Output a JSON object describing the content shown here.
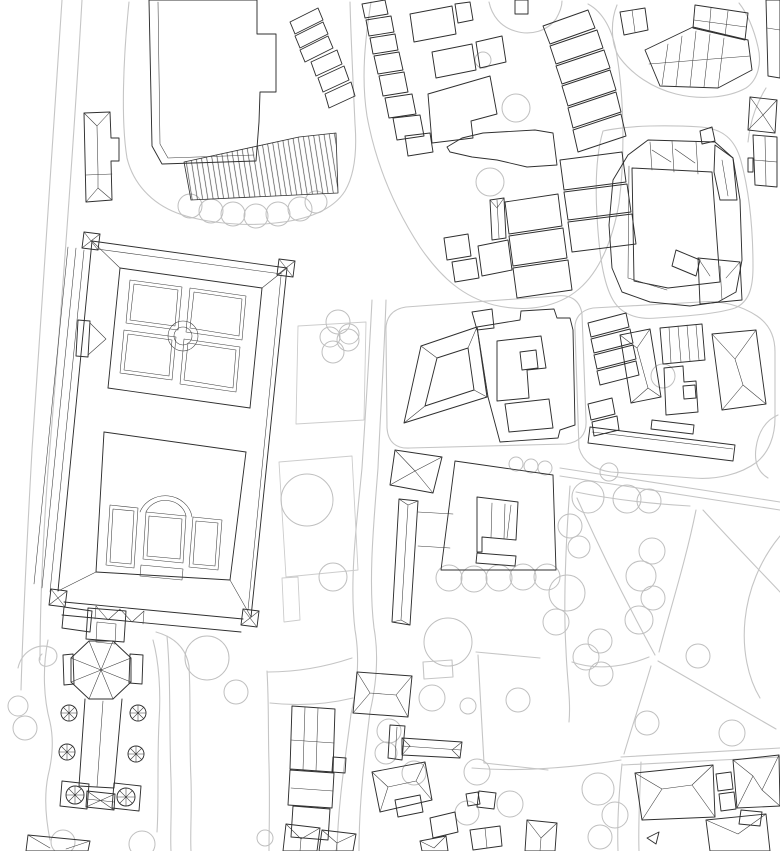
{
  "canvas": {
    "width": 780,
    "height": 851,
    "background": "#ffffff"
  },
  "palette": {
    "ink": "#2f2f2f",
    "detail": "#3c3c3c",
    "road": "#c5c5c5",
    "tree": "#bfbfbf",
    "bed": "#cccccc",
    "hatch": "#4a4a4a"
  },
  "layers": [
    {
      "id": "roads",
      "color": "road",
      "width": 1.1,
      "paths": [
        "M62,0 C54,130 42,300 32,450 C27,540 23,620 21,690",
        "M82,0 C74,140 60,330 48,470 C43,540 40,600 40,660",
        "M129,2 C123,60 121,122 127,158 C133,183 151,203 177,213 C201,222 241,227 275,223 C307,220 333,210 345,191 C355,174 357,150 355,124 C353,80 351,40 350,2",
        "M371,2 C365,40 361,78 367,116 C375,160 392,204 420,247 C442,279 464,297 494,305 C527,313 558,307 579,289 C600,271 613,239 619,203 C625,158 624,98 617,56 C613,30 603,12 588,4",
        "M489,2 C492,16 501,27 515,31 C531,36 547,31 556,19 C560,12 562,6 562,1",
        "M617,5 C610,22 611,46 620,58 C632,74 652,88 676,94 C700,100 728,98 746,88 C758,80 762,63 758,47 C754,29 747,13 739,3",
        "M603,131 C597,151 595,181 597,216 C599,252 603,283 613,300 C621,314 637,320 657,318 C687,316 717,314 735,308 C749,302 753,288 753,267 C753,229 749,191 741,161 C735,139 723,129 701,127 C669,125 630,125 603,131 Z",
        "M766,88 C756,104 750,122 748,142",
        "M386,332 C385,318 392,309 406,307 L556,296 C570,294 580,300 582,314 L586,420 C587,434 580,442 566,444 L410,448 C396,449 388,442 387,428 Z",
        "M575,330 C574,318 581,310 593,308 L700,302 C722,300 742,306 757,316 C769,324 775,336 775,352 L775,418 C775,436 769,452 757,462 C741,474 717,480 693,478 L611,472 C595,470 583,462 579,448 Z",
        "M560,468 L780,502",
        "M560,476 L780,510",
        "M372,300 C369,360 365,420 362,468 C357,520 349,580 355,630 C360,658 357,688 351,714 C346,754 338,802 337,851",
        "M386,300 C384,360 380,420 378,468 C374,520 368,580 374,628 C379,656 376,686 370,712 C365,752 359,802 359,851",
        "M352,658 C322,668 294,672 268,672",
        "M353,698 C324,705 297,706 270,703",
        "M189,666 C191,700 189,740 191,780 C192,812 190,832 191,851",
        "M267,671 C269,704 268,734 269,764 C270,802 269,830 269,851",
        "M189,666 C186,648 174,637 156,632",
        "M570,486 C566,540 563,600 566,650 C567,680 571,700 569,722",
        "M576,492 C615,500 655,504 690,506",
        "M577,498 C598,545 625,600 655,655",
        "M696,510 C686,560 670,610 659,652",
        "M703,510 C733,543 762,573 780,592",
        "M658,661 L776,729",
        "M651,666 C641,700 631,730 624,754",
        "M621,757 L780,748",
        "M623,765 L780,757",
        "M649,657 C622,668 594,670 572,662",
        "M780,536 C760,560 748,590 745,620 C742,650 748,678 760,698",
        "M622,764 C619,792 617,822 618,851",
        "M641,762 C640,792 638,822 639,851",
        "M621,760 C570,768 520,772 472,768",
        "M778,415 C766,420 758,432 756,448 C754,462 758,472 768,478",
        "M476,652 L540,658 M478,655 L484,763 M484,763 L548,770",
        "M153,640 C159,662 161,692 159,722 C157,762 159,802 157,832",
        "M167,636 C171,680 169,730 171,780 C172,812 170,832 171,851",
        "M48,640 C42,670 44,700 50,722 C54,740 52,760 48,776 C44,796 46,820 50,840",
        "M18,668 C22,650 40,642 52,648 C60,652 58,664 48,666 C40,668 36,659 42,654",
        "M423,662 L452,660 L453,677 L424,679 Z"
      ]
    },
    {
      "id": "garden-beds",
      "color": "bed",
      "width": 0.9,
      "paths": [
        "M298,326 L366,322 L364,420 L296,424 Z",
        "M279,462 L352,456 L358,570 L286,577 Z",
        "M282,578 L298,577 L300,620 L284,622 Z"
      ]
    },
    {
      "id": "trees",
      "color": "tree",
      "width": 1.0,
      "circles": [
        [
          190,
          206,
          12
        ],
        [
          211,
          211,
          12
        ],
        [
          233,
          214,
          12
        ],
        [
          256,
          216,
          12
        ],
        [
          278,
          214,
          12
        ],
        [
          300,
          209,
          12
        ],
        [
          316,
          202,
          11
        ],
        [
          516,
          108,
          14
        ],
        [
          490,
          182,
          14
        ],
        [
          483,
          60,
          8
        ],
        [
          338,
          322,
          12
        ],
        [
          330,
          337,
          10
        ],
        [
          348,
          340,
          11
        ],
        [
          333,
          352,
          11
        ],
        [
          349,
          334,
          10
        ],
        [
          307,
          500,
          26
        ],
        [
          333,
          577,
          14
        ],
        [
          663,
          376,
          12
        ],
        [
          449,
          578,
          13
        ],
        [
          474,
          579,
          13
        ],
        [
          499,
          578,
          13
        ],
        [
          523,
          577,
          13
        ],
        [
          547,
          577,
          13
        ],
        [
          516,
          464,
          7
        ],
        [
          531,
          466,
          7
        ],
        [
          545,
          468,
          7
        ],
        [
          207,
          658,
          22
        ],
        [
          236,
          692,
          12
        ],
        [
          25,
          728,
          12
        ],
        [
          18,
          706,
          10
        ],
        [
          63,
          842,
          12
        ],
        [
          142,
          844,
          13
        ],
        [
          265,
          838,
          8
        ],
        [
          588,
          497,
          16
        ],
        [
          570,
          526,
          12
        ],
        [
          579,
          547,
          11
        ],
        [
          627,
          499,
          14
        ],
        [
          649,
          501,
          12
        ],
        [
          567,
          593,
          18
        ],
        [
          556,
          622,
          13
        ],
        [
          652,
          551,
          13
        ],
        [
          641,
          576,
          15
        ],
        [
          653,
          598,
          12
        ],
        [
          639,
          620,
          14
        ],
        [
          600,
          641,
          12
        ],
        [
          586,
          657,
          13
        ],
        [
          601,
          674,
          12
        ],
        [
          647,
          723,
          12
        ],
        [
          698,
          656,
          12
        ],
        [
          732,
          733,
          13
        ],
        [
          609,
          472,
          9
        ],
        [
          448,
          642,
          24
        ],
        [
          477,
          772,
          13
        ],
        [
          510,
          804,
          13
        ],
        [
          467,
          813,
          12
        ],
        [
          414,
          773,
          12
        ],
        [
          389,
          731,
          12
        ],
        [
          386,
          753,
          11
        ],
        [
          432,
          698,
          13
        ],
        [
          468,
          706,
          8
        ],
        [
          598,
          789,
          16
        ],
        [
          615,
          815,
          13
        ],
        [
          600,
          837,
          12
        ],
        [
          518,
          700,
          12
        ]
      ]
    },
    {
      "id": "hatch-areas",
      "color": "ink",
      "width": 0.8,
      "fill": "hatch-pattern",
      "paths": [
        "M184,162 L299,137 L336,133 L338,193 L191,200 Z"
      ]
    },
    {
      "id": "buildings",
      "color": "ink",
      "width": 0.95,
      "circles": [
        [
          69,
          713,
          8
        ],
        [
          67,
          752,
          8
        ],
        [
          138,
          713,
          8
        ],
        [
          136,
          754,
          8
        ],
        [
          75,
          795,
          9
        ],
        [
          126,
          797,
          9
        ]
      ],
      "paths": [
        "M149,0 L152,146 L162,164 L256,161 L259,122 L260,92 L276,92 L276,34 L257,34 L257,0 Z",
        "M84,113 L110,112 L111,138 L119,138 L119,161 L111,161 L112,200 L86,202 Z",
        "M290,22 L318,8 L323,20 L295,34 Z",
        "M295,36 L323,22 L328,34 L300,48 Z",
        "M300,50 L328,36 L333,48 L305,62 Z",
        "M311,62 L337,50 L342,64 L316,76 Z",
        "M318,78 L344,66 L349,80 L323,92 Z",
        "M325,94 L351,82 L355,96 L329,108 Z",
        "M362,4 L385,0 L388,14 L365,18 Z",
        "M366,20 L391,16 L394,32 L369,36 Z",
        "M370,38 L395,34 L398,50 L373,54 Z",
        "M374,56 L399,52 L403,70 L378,74 Z",
        "M379,76 L404,72 L408,92 L383,96 Z",
        "M385,98 L412,94 L416,114 L389,118 Z",
        "M393,118 L420,115 L424,136 L397,140 Z",
        "M405,136 L430,133 L433,152 L408,156 Z",
        "M410,14 L452,6 L456,34 L414,42 Z",
        "M455,4 L470,2 L473,20 L458,23 Z",
        "M432,52 L472,44 L476,70 L436,78 Z",
        "M476,42 L502,36 L506,62 L480,68 Z",
        "M515,0 L528,0 L528,14 L515,14 Z",
        "M428,94 L490,76 L497,114 L471,121 L473,138 L432,143 Z",
        "M447,147 L462,138 L483,133 L535,130 L553,133 L557,165 L527,167 L497,160 L472,157 L450,152 Z",
        "M543,26 L588,10 L595,28 L550,44 Z",
        "M550,46 L597,30 L603,48 L556,64 Z",
        "M556,66 L604,50 L610,68 L562,84 Z",
        "M562,86 L610,70 L616,90 L568,106 Z",
        "M568,108 L616,92 L621,112 L573,128 Z",
        "M573,130 L621,114 L626,136 L578,152 Z",
        "M560,160 L622,152 L626,182 L564,190 Z",
        "M564,192 L627,184 L631,212 L568,220 Z",
        "M568,222 L632,214 L636,244 L572,252 Z",
        "M505,202 L558,194 L562,226 L509,234 Z",
        "M509,236 L563,228 L567,258 L513,266 Z",
        "M478,246 L508,240 L512,270 L482,276 Z",
        "M513,268 L568,260 L572,290 L517,298 Z",
        "M490,200 L504,198 L506,238 L492,240 Z",
        "M444,238 L468,234 L471,256 L447,260 Z",
        "M452,262 L476,258 L479,278 L455,282 Z",
        "M695,5 L748,13 L745,40 L693,28 Z",
        "M645,50 L693,27 L748,40 L752,70 L718,88 L660,86 Z",
        "M620,12 L645,8 L648,30 L624,35 Z",
        "M648,140 L715,142 L733,158 L740,200 L742,260 L736,292 L718,302 L690,306 L650,302 L622,292 L612,268 L609,225 L613,180 L628,155 Z",
        "M632,168 L712,172 L720,282 L668,288 L634,281 Z",
        "M715,145 L733,158 L737,200 L720,200 L714,172 Z",
        "M700,131 L712,127 L715,141 L702,144 Z",
        "M698,258 L740,262 L742,300 L700,304 Z",
        "M676,250 L700,260 L696,276 L672,266 Z",
        "M750,97 L777,100 L775,133 L748,130 Z",
        "M766,0 L780,0 L780,78 L768,76 Z",
        "M753,135 L777,137 L777,187 L755,185 Z",
        "M748,158 L753,158 L753,172 L748,172 Z",
        "M421,346 L477,327 L487,397 L404,423 Z",
        "M437,358 L468,348 L474,390 L425,406 Z",
        "M472,312 L492,309 L494,328 L477,330 Z",
        "M477,327 L520,320 L521,311 L554,309 L557,318 L570,318 L573,330 L575,425 L560,430 L558,438 L500,442 L488,397 Z",
        "M497,341 L541,336 L546,368 L527,370 L529,398 L497,401 Z",
        "M520,352 L536,350 L538,368 L522,370 Z",
        "M505,404 L549,399 L553,428 L509,432 Z",
        "M588,323 L626,313 L629,327 L591,337 Z",
        "M591,339 L630,329 L633,343 L594,353 Z",
        "M594,355 L633,345 L636,359 L597,369 Z",
        "M597,371 L636,361 L639,375 L600,385 Z",
        "M620,335 L650,329 L661,397 L631,403 Z",
        "M588,404 L612,398 L615,414 L591,420 Z",
        "M592,422 L617,416 L619,430 L594,436 Z",
        "M660,328 L702,324 L705,360 L663,364 Z",
        "M664,368 L683,366 L684,382 L696,381 L698,412 L666,415 Z",
        "M683,386 L695,385 L696,398 L684,399 Z",
        "M712,334 L756,330 L766,404 L722,410 Z",
        "M590,427 L735,445 L733,461 L588,443 Z",
        "M652,420 L694,425 L693,434 L651,429 Z",
        "M395,450 L442,457 L433,493 L390,485 Z",
        "M399,499 L418,501 L410,625 L392,622 Z",
        "M455,461 L553,475 L556,570 L441,570 Z",
        "M477,497 L518,502 L516,540 L482,537 L482,552 L477,552 Z",
        "M477,553 L516,556 L515,566 L476,563 Z",
        "M84,232 L100,234 L98,250 L82,248 Z",
        "M279,259 L295,261 L293,277 L277,275 Z",
        "M51,589 L67,591 L65,607 L49,605 Z",
        "M243,609 L259,611 L257,627 L241,625 Z",
        "M92,241 L287,268 L251,617",
        "M92,241 L58,591",
        "M64,602 L243,619",
        "M62,615 L241,632",
        "M120,268 L262,288",
        "M120,268 L108,388",
        "M104,432 L96,572",
        "M262,288 L250,408",
        "M246,452 L230,580",
        "M108,388 L250,408",
        "M104,432 L246,452",
        "M96,572 L230,580",
        "M78,320 L90,321 L88,357 L76,356 Z",
        "M64,607 L92,611 L90,632 L62,628 Z",
        "M88,608 L126,611 L124,642 L86,639 Z",
        "M131,658 L113,641 L89,641 L71,658 L71,682 L89,699 L113,699 L131,682 Z",
        "M63,655 L73,654 L74,684 L64,685 Z",
        "M130,654 L143,655 L142,684 L129,683 Z",
        "M85,699 L79,786 M122,699 L114,788 M79,786 L114,788",
        "M62,781 L89,784 L87,809 L60,806 Z",
        "M114,783 L141,786 L139,811 L112,808 Z",
        "M87,791 L115,794 L114,810 L86,807 Z",
        "M292,706 L335,709 L333,772 L290,769 Z",
        "M290,770 L334,773 L332,808 L288,805 Z",
        "M333,757 L346,758 L345,773 L332,772 Z",
        "M293,806 L330,809 L328,840 L291,837 Z",
        "M286,824 L320,828 L317,851 L283,851 Z",
        "M322,830 L356,834 L353,851 L319,851 Z",
        "M28,835 L90,841 L88,851 L26,851 Z",
        "M357,672 L412,676 L408,717 L353,713 Z",
        "M390,725 L405,726 L402,760 L388,758 Z",
        "M402,738 L462,742 L460,758 L402,755 Z",
        "M372,772 L425,762 L432,800 L380,812 Z",
        "M395,800 L420,795 L423,812 L398,817 Z",
        "M430,818 L455,812 L458,832 L433,838 Z",
        "M470,830 L500,826 L502,846 L473,850 Z",
        "M479,791 L496,793 L494,809 L477,807 Z",
        "M466,794 L478,792 L480,804 L468,806 Z",
        "M527,820 L557,823 L555,851 L525,851 Z",
        "M420,841 L446,836 L448,851 L422,851 Z",
        "M635,773 L713,765 L715,817 L642,820 Z",
        "M716,774 L731,772 L733,789 L718,791 Z",
        "M719,794 L734,792 L736,809 L721,811 Z",
        "M733,760 L779,755 L780,806 L737,808 Z",
        "M741,810 L762,812 L760,826 L739,824 Z",
        "M706,820 L766,814 L770,851 L710,851 Z",
        "M647,838 L659,832 L656,844 Z"
      ]
    },
    {
      "id": "roof-details",
      "color": "detail",
      "width": 0.55,
      "circles": [
        [
          183,
          336,
          15
        ],
        [
          183,
          336,
          9
        ]
      ],
      "paths": [
        "M158,2 L160,144 L168,158 L254,155",
        "M97,126 L98,172 M84,113 L97,126 M110,112 L97,126 M86,202 L98,188 M112,200 L98,188 M98,172 L98,188 M86,175 L112,174",
        "M497,200 L499,238 M490,200 L497,208 L504,198",
        "M711,8 L709,32 M728,11 L725,36 M694,20 L746,27",
        "M662,85 L668,44 M676,86 L682,36 M690,87 L696,31 M704,87 L710,34 M718,88 L724,38 M649,64 L750,56",
        "M632,10 L635,32",
        "M629,166 L628,278 L667,290",
        "M650,142 L652,170 M672,141 L674,172 M696,142 L698,174 M652,150 L671,162 M675,149 L695,163",
        "M722,160 L728,196",
        "M720,266 L722,300 M698,258 L710,276 M740,262 L726,278",
        "M750,97 L763,115 L777,100 M748,130 L763,115 L775,133",
        "M767,28 L780,30",
        "M754,160 L777,162 M765,137 L766,186",
        "M421,346 L437,358 M477,327 L468,348 M487,397 L474,390 M404,423 L425,406 M477,327 L488,397",
        "M637,348 L648,388 M620,335 L637,348 M650,329 L637,348 M631,403 L648,388 M661,397 L648,388",
        "M669,327 L671,363 M678,326 L681,362 M687,325 L690,361 M696,325 L699,360",
        "M735,359 L743,385 M712,334 L735,359 M756,330 L735,359 M722,410 L743,385 M766,404 L743,385",
        "M592,432 L733,449",
        "M395,450 L415,471 M442,457 L415,471 M433,493 L415,471 M390,485 L415,471",
        "M408,505 L401,620 M399,499 L408,505 L418,501 M392,622 L401,620 L410,625",
        "M418,512 L453,514 M418,546 L450,548",
        "M492,503 L491,538 M505,504 L504,539 M511,505 L507,538",
        "M84,232 L98,250 M100,234 L82,248 M279,259 L293,277 M295,261 L277,275 M51,589 L65,607 M67,591 L49,605 M243,609 L257,627 M259,611 L241,625",
        "M97,249 L282,274 M281,276 L248,610",
        "M84,250 L50,592 M76,248 L42,588 M68,247 L34,584",
        "M92,241 L120,268 M287,268 L262,288 M251,617 L230,580 M58,591 L96,572",
        "M96,606 L108,620 L120,609 L132,622 L144,611 M96,606 L95,619 M144,611 L143,624",
        "M90,323 L106,339 L88,355",
        "M130,280 L182,287 L178,330 L126,323 Z",
        "M134,284 L178,290 L175,326 L130,320 Z",
        "M190,288 L246,296 L242,340 L186,332 Z",
        "M194,292 L242,299 L239,336 L190,328 Z",
        "M124,330 L176,337 L172,380 L120,373 Z",
        "M128,334 L172,340 L169,376 L124,370 Z",
        "M184,339 L240,347 L236,392 L180,384 Z",
        "M188,343 L236,350 L233,388 L184,380 Z",
        "M110,505 L138,508 L134,568 L106,565 Z",
        "M113,509 L134,511 L131,564 L110,562 Z",
        "M146,512 L186,516 L183,563 L143,559 Z",
        "M149,516 L182,519 L180,559 L147,556 Z",
        "M193,517 L222,520 L218,570 L189,567 Z",
        "M196,521 L218,523 L215,566 L193,564 Z",
        "M141,565 L183,569 L182,580 L140,576 Z",
        "M140,512 A27,25 0 0 1 192,517",
        "M146,512 A21,19 0 0 1 186,516",
        "M97,622 L116,624 L115,644 L96,642 Z",
        "M101,670 L131,658 M101,670 L113,641 M101,670 L89,641 M101,670 L71,658 M101,670 L71,682 M101,670 L89,699 M101,670 L113,699 M101,670 L131,682",
        "M103,701 L97,787",
        "M61,713 L77,713 M69,705 L69,721 M63,707 L75,719 M75,707 L63,719",
        "M59,752 L75,752 M67,744 L67,760 M61,746 L73,758 M73,746 L61,758",
        "M130,713 L146,713 M138,705 L138,721 M132,707 L144,719 M144,707 L132,719",
        "M128,754 L144,754 M136,746 L136,762 M130,748 L142,760 M142,748 L130,760",
        "M66,795 L84,795 M75,786 L75,804 M69,789 L81,801 M81,789 L69,801",
        "M117,797 L135,797 M126,788 L126,806 M120,791 L132,803 M132,791 L120,803",
        "M87,791 L114,810 M115,794 L86,807 M87,799 L114,802",
        "M305,707 L303,770 M318,708 L316,771 M291,740 L334,743 M291,788 L333,791",
        "M286,824 L301,839 M320,828 L301,839 M301,839 L300,851 M322,830 L337,843 M356,834 L337,843 M337,843 L336,851",
        "M28,835 L50,848 M90,841 L66,849",
        "M370,693 L396,695 M357,672 L370,693 M353,713 L370,693 M412,676 L396,695 M408,717 L396,695",
        "M397,727 L395,759",
        "M402,746 L461,750 M402,738 L410,746 M402,755 L410,746 M462,742 L452,750 M460,758 L452,750",
        "M388,787 L416,781 M372,772 L388,787 M380,812 L388,787 M425,762 L416,781 M432,800 L416,781",
        "M485,828 L487,848",
        "M527,820 L541,838 M557,823 L541,838 M541,838 L540,851",
        "M420,841 L434,848 M446,836 L434,848",
        "M662,789 L692,785 M635,773 L662,789 M642,820 L662,789 M713,765 L692,785 M715,817 L692,785",
        "M753,776 L762,790 M733,760 L753,776 M737,808 L753,776 M779,755 L762,790 M780,806 L762,790",
        "M706,820 L738,834 M766,814 L738,834"
      ]
    }
  ]
}
